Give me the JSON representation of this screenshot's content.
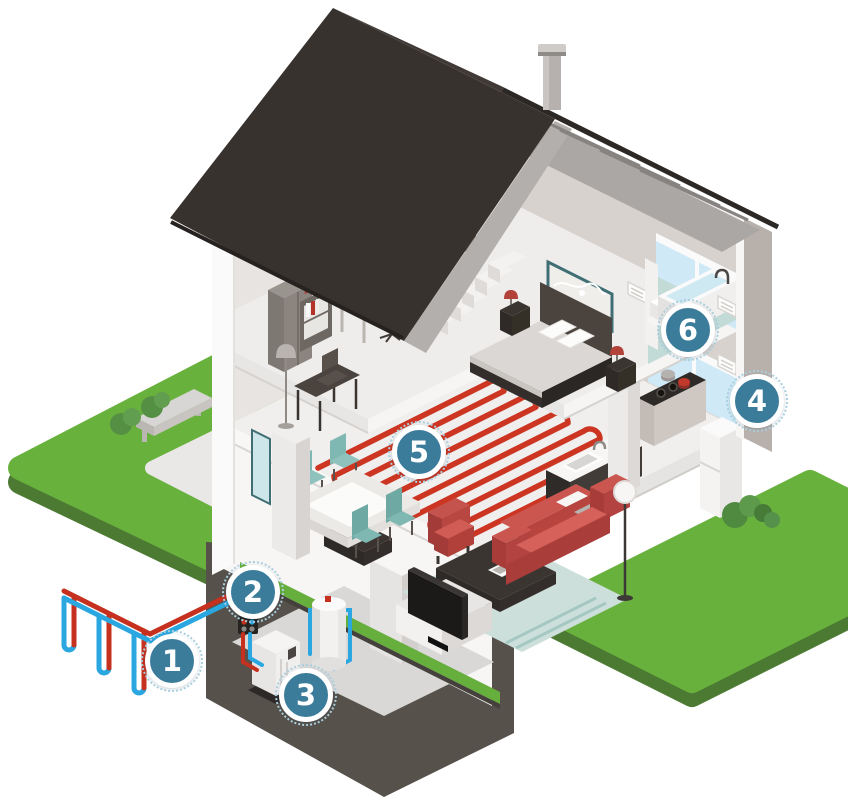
{
  "illustration": {
    "scene": "house-heating-system-cutaway",
    "markers": [
      {
        "number": "1",
        "target": "ground-loop-collector"
      },
      {
        "number": "2",
        "target": "supply-lines"
      },
      {
        "number": "3",
        "target": "heat-pump-unit"
      },
      {
        "number": "4",
        "target": "building-exterior-wall"
      },
      {
        "number": "5",
        "target": "underfloor-heating"
      },
      {
        "number": "6",
        "target": "bathroom"
      }
    ],
    "colors": {
      "marker_accent": "#3b7c9a",
      "grass": "#69b13d",
      "grass_edge": "#4c7a33",
      "roof": "#38322f",
      "pipe_warm": "#c5301f",
      "pipe_cold": "#2aa7e0"
    }
  }
}
